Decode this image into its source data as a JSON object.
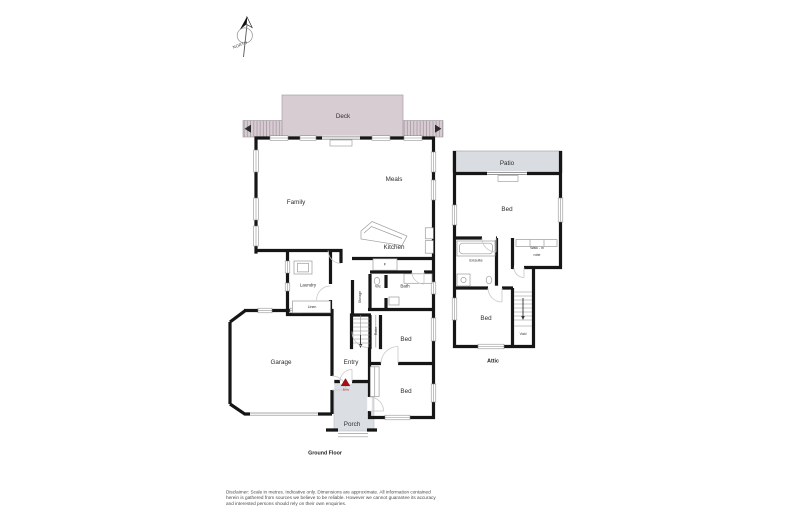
{
  "plan": {
    "compass": "NORTH",
    "ground_floor": {
      "title": "Ground Floor",
      "rooms": {
        "deck": "Deck",
        "family": "Family",
        "meals": "Meals",
        "kitchen": "Kitchen",
        "fridge": "F",
        "laundry": "Laundry",
        "linen": "Linen",
        "storage": "Storage",
        "wc": "Wc",
        "bath": "Bath",
        "robe": "Robe",
        "bed_middle": "Bed",
        "bed_front": "Bed",
        "entry": "Entry",
        "garage": "Garage",
        "porch": "Porch"
      },
      "entry_marker": "Entry"
    },
    "attic": {
      "title": "Attic",
      "rooms": {
        "patio": "Patio",
        "bed_main": "Bed",
        "ensuite": "Ensuite",
        "walk_in_robe_line1": "Walk - in",
        "walk_in_robe_line2": "robe",
        "bed_second": "Bed",
        "void": "Void"
      }
    },
    "disclaimer": {
      "line1": "Disclaimer: Scale in metres. Indicative only. Dimensions are approximate. All information contained",
      "line2": "herein is gathered from sources we believe to be reliable. However we cannot guarantee its accuracy",
      "line3": "and interested persons should rely on their own enquiries."
    },
    "colors": {
      "wall": "#161616",
      "deck_fill": "#d8ccd3",
      "paving_fill": "#dbdee2",
      "marker_red": "#a50f15"
    }
  }
}
